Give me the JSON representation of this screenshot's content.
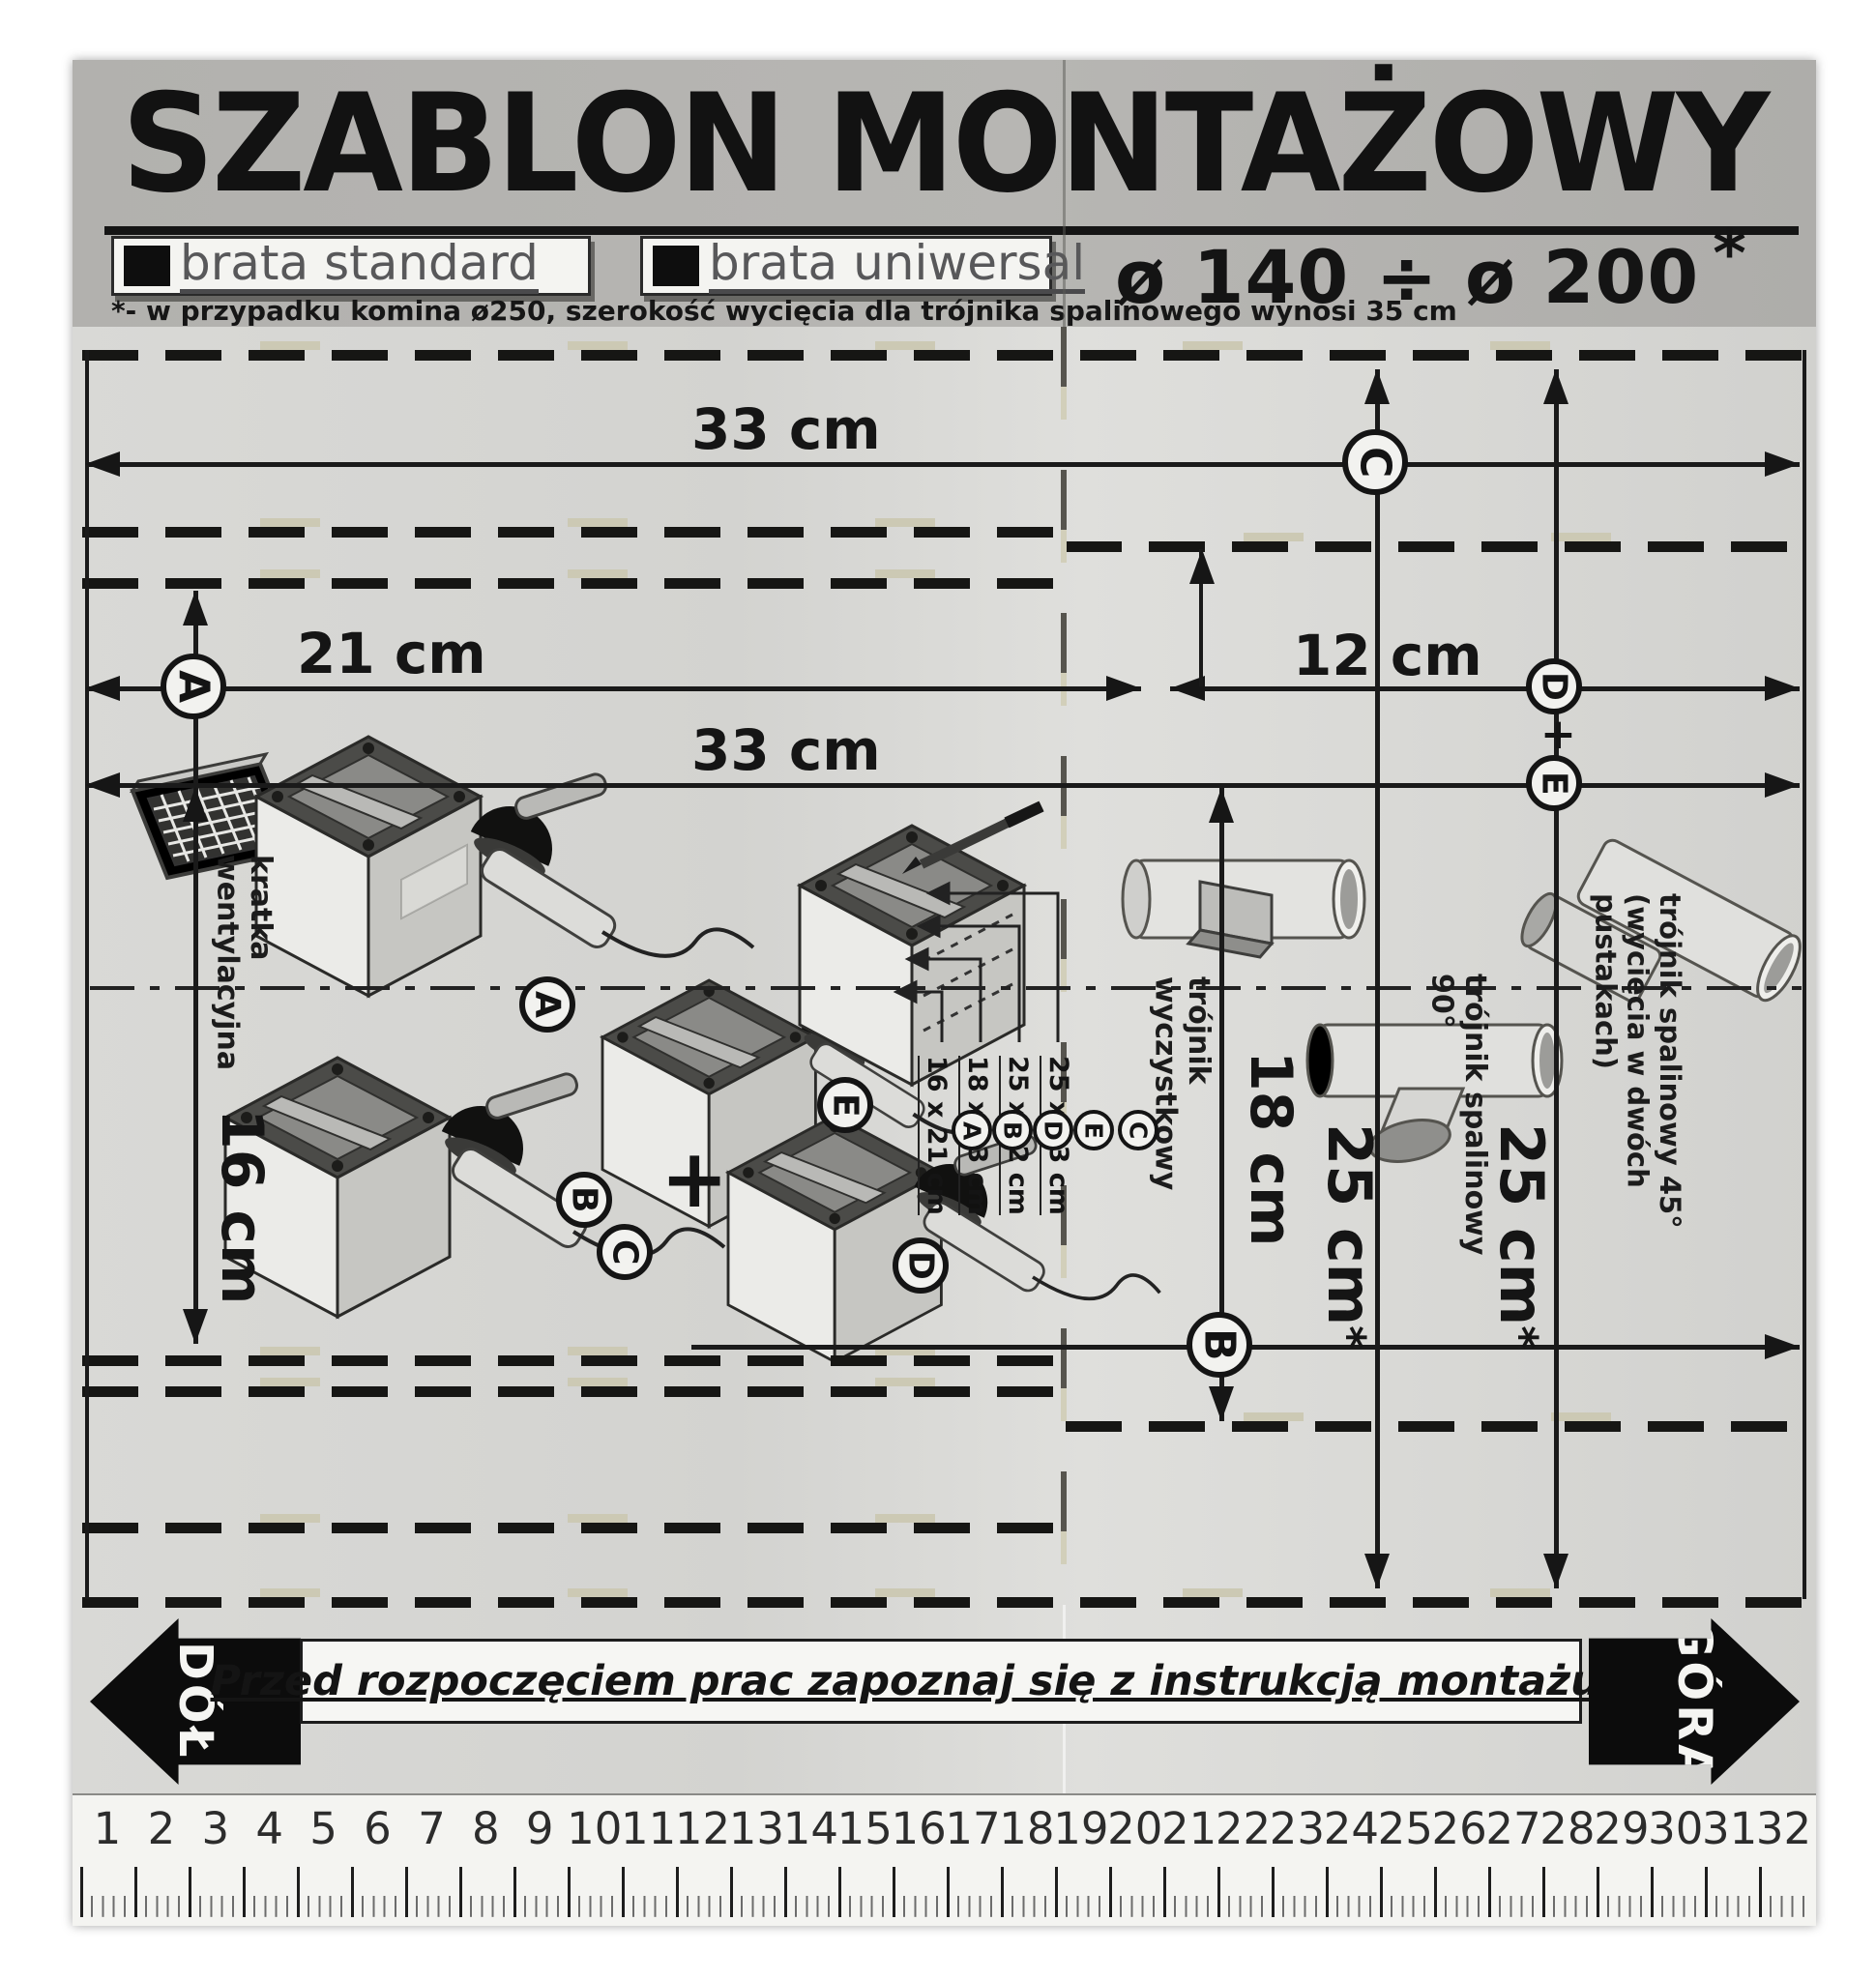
{
  "header": {
    "title": "SZABLON MONTAŻOWY",
    "brand_standard": "brata standard",
    "brand_universal": "brata uniwersal",
    "diameter_range": "ø 140 ÷ ø 200",
    "diameter_star": "*",
    "footnote": "*- w przypadku komina ø250, szerokość wycięcia dla trójnika spalinowego wynosi 35 cm"
  },
  "dimensions": {
    "top_width": "33 cm",
    "mid_width": "33 cm",
    "left_width": "21 cm",
    "right_offset": "12 cm",
    "vent_height": "16 cm",
    "cleanout_height": "18 cm",
    "flue90_height": "25 cm",
    "flue90_star": "*",
    "flue45_height": "25 cm",
    "flue45_star": "*"
  },
  "markers": {
    "a": "A",
    "b": "B",
    "c": "C",
    "d": "D",
    "e": "E",
    "plus": "+"
  },
  "labels": {
    "vent_grille": "kratka wentylacyjna",
    "cleanout_tee": "trójnik wyczystkowy",
    "flue_tee_90": "trójnik spalinowy 90°",
    "flue_tee_45": "trójnik spalinowy 45°",
    "flue_tee_45_note": "(wycięcia w dwóch pustakach)"
  },
  "cut_table": {
    "rows": [
      {
        "letters": [
          "C",
          "E"
        ],
        "size": "25 x 33 cm"
      },
      {
        "letters": [
          "D"
        ],
        "size": "25 x 12 cm"
      },
      {
        "letters": [
          "B"
        ],
        "size": "18 x 33 cm"
      },
      {
        "letters": [
          "A"
        ],
        "size": "16 x 21 cm"
      }
    ]
  },
  "footer": {
    "warning": "Przed rozpoczęciem prac zapoznaj się z instrukcją montażu !!!",
    "down_label": "DÓŁ",
    "up_label": "GÓRA"
  },
  "ruler": {
    "numbers": [
      1,
      2,
      3,
      4,
      5,
      6,
      7,
      8,
      9,
      10,
      11,
      12,
      13,
      14,
      15,
      16,
      17,
      18,
      19,
      20,
      21,
      22,
      23,
      24,
      25,
      26,
      27,
      28,
      29,
      30,
      31,
      32
    ]
  }
}
